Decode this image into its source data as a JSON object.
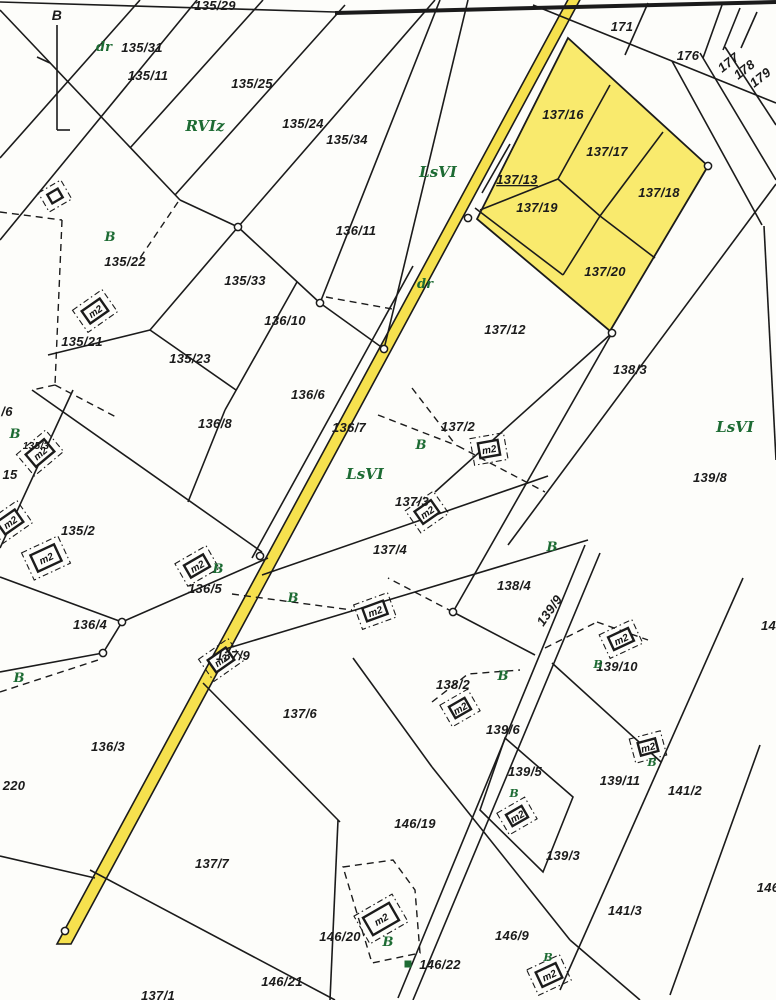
{
  "map": {
    "type": "cadastral-parcel-map",
    "colors": {
      "background": "#fdfdfa",
      "line": "#1b1b1b",
      "road_fill": "#f6e14e",
      "highlight_parcel_fill": "#f9ea6d",
      "green_annotation": "#1d6b33"
    },
    "highlighted_parcels": [
      "137/13",
      "137/16",
      "137/17",
      "137/18",
      "137/19",
      "137/20"
    ],
    "parcel_labels": [
      {
        "text": "135/29",
        "x": 215,
        "y": 10
      },
      {
        "text": "B",
        "x": 57,
        "y": 20,
        "size": 14
      },
      {
        "text": "135/31",
        "x": 142,
        "y": 52
      },
      {
        "text": "135/11",
        "x": 148,
        "y": 80
      },
      {
        "text": "135/25",
        "x": 252,
        "y": 88
      },
      {
        "text": "135/24",
        "x": 303,
        "y": 128
      },
      {
        "text": "135/34",
        "x": 347,
        "y": 144
      },
      {
        "text": "171",
        "x": 622,
        "y": 31
      },
      {
        "text": "176",
        "x": 688,
        "y": 60
      },
      {
        "text": "177",
        "x": 731,
        "y": 66,
        "rot": -38
      },
      {
        "text": "178",
        "x": 747,
        "y": 73,
        "rot": -38
      },
      {
        "text": "179",
        "x": 763,
        "y": 81,
        "rot": -38
      },
      {
        "text": "137/16",
        "x": 563,
        "y": 119
      },
      {
        "text": "137/17",
        "x": 607,
        "y": 156
      },
      {
        "text": "137/13",
        "x": 517,
        "y": 184,
        "underline": true
      },
      {
        "text": "137/18",
        "x": 659,
        "y": 197
      },
      {
        "text": "137/19",
        "x": 537,
        "y": 212
      },
      {
        "text": "137/20",
        "x": 605,
        "y": 276
      },
      {
        "text": "136/11",
        "x": 356,
        "y": 235
      },
      {
        "text": "135/22",
        "x": 125,
        "y": 266
      },
      {
        "text": "135/33",
        "x": 245,
        "y": 285
      },
      {
        "text": "136/10",
        "x": 285,
        "y": 325
      },
      {
        "text": "135/21",
        "x": 82,
        "y": 346
      },
      {
        "text": "135/23",
        "x": 190,
        "y": 363
      },
      {
        "text": "137/12",
        "x": 505,
        "y": 334
      },
      {
        "text": "138/3",
        "x": 630,
        "y": 374
      },
      {
        "text": "136/6",
        "x": 308,
        "y": 399
      },
      {
        "text": "136/8",
        "x": 215,
        "y": 428
      },
      {
        "text": "136/7",
        "x": 349,
        "y": 432
      },
      {
        "text": "137/2",
        "x": 458,
        "y": 431
      },
      {
        "text": "139/8",
        "x": 710,
        "y": 482
      },
      {
        "text": "137/3",
        "x": 412,
        "y": 506
      },
      {
        "text": "135/2",
        "x": 78,
        "y": 535
      },
      {
        "text": "135/3",
        "x": 36,
        "y": 449,
        "size": 10
      },
      {
        "text": "15",
        "x": 10,
        "y": 479
      },
      {
        "text": "/6",
        "x": 7,
        "y": 416
      },
      {
        "text": "137/4",
        "x": 390,
        "y": 554
      },
      {
        "text": "138/4",
        "x": 514,
        "y": 590
      },
      {
        "text": "136/5",
        "x": 205,
        "y": 593
      },
      {
        "text": "139/9",
        "x": 553,
        "y": 613,
        "rot": -55
      },
      {
        "text": "136/4",
        "x": 90,
        "y": 629
      },
      {
        "text": "139/10",
        "x": 617,
        "y": 671
      },
      {
        "text": "138/2",
        "x": 453,
        "y": 689
      },
      {
        "text": "137/6",
        "x": 300,
        "y": 718
      },
      {
        "text": "139/6",
        "x": 503,
        "y": 734
      },
      {
        "text": "136/3",
        "x": 108,
        "y": 751
      },
      {
        "text": "137/9",
        "x": 233,
        "y": 660
      },
      {
        "text": "139/5",
        "x": 525,
        "y": 776
      },
      {
        "text": "139/11",
        "x": 620,
        "y": 785
      },
      {
        "text": "141/2",
        "x": 685,
        "y": 795
      },
      {
        "text": "220",
        "x": 14,
        "y": 790
      },
      {
        "text": "146/19",
        "x": 415,
        "y": 828
      },
      {
        "text": "137/7",
        "x": 212,
        "y": 868
      },
      {
        "text": "139/3",
        "x": 563,
        "y": 860
      },
      {
        "text": "141/3",
        "x": 625,
        "y": 915
      },
      {
        "text": "141/2",
        "x": 778,
        "y": 630
      },
      {
        "text": "146/9",
        "x": 512,
        "y": 940
      },
      {
        "text": "146/20",
        "x": 340,
        "y": 941
      },
      {
        "text": "146/22",
        "x": 440,
        "y": 969
      },
      {
        "text": "146/21",
        "x": 282,
        "y": 986
      },
      {
        "text": "146/",
        "x": 770,
        "y": 892
      },
      {
        "text": "137/1",
        "x": 158,
        "y": 1000
      }
    ],
    "land_use_labels": [
      {
        "text": "RVIz",
        "x": 205,
        "y": 131,
        "size": 15
      },
      {
        "text": "LsVI",
        "x": 438,
        "y": 177,
        "size": 15
      },
      {
        "text": "LsVI",
        "x": 365,
        "y": 479,
        "size": 15
      },
      {
        "text": "LsVI",
        "x": 735,
        "y": 432,
        "size": 15
      },
      {
        "text": "dr",
        "x": 104,
        "y": 51
      },
      {
        "text": "dr",
        "x": 425,
        "y": 288
      },
      {
        "text": "B",
        "x": 110,
        "y": 241
      },
      {
        "text": "B",
        "x": 15,
        "y": 438
      },
      {
        "text": "B",
        "x": 421,
        "y": 449
      },
      {
        "text": "B",
        "x": 218,
        "y": 573
      },
      {
        "text": "B",
        "x": 293,
        "y": 602
      },
      {
        "text": "B",
        "x": 552,
        "y": 551
      },
      {
        "text": "B",
        "x": 19,
        "y": 682
      },
      {
        "text": "B",
        "x": 503,
        "y": 680
      },
      {
        "text": "B",
        "x": 598,
        "y": 668,
        "size": 11
      },
      {
        "text": "B",
        "x": 652,
        "y": 766,
        "size": 11
      },
      {
        "text": "B",
        "x": 514,
        "y": 797,
        "size": 11
      },
      {
        "text": "B",
        "x": 388,
        "y": 946
      },
      {
        "text": "B",
        "x": 548,
        "y": 961,
        "size": 11
      }
    ],
    "building_symbols": [
      {
        "label": "m2",
        "x": 95,
        "y": 311,
        "rot": -35,
        "w": 22,
        "h": 15
      },
      {
        "label": "m2",
        "x": 40,
        "y": 453,
        "rot": -40,
        "w": 24,
        "h": 16
      },
      {
        "label": "m2",
        "x": 10,
        "y": 522,
        "rot": -35,
        "w": 22,
        "h": 15
      },
      {
        "label": "m2",
        "x": 46,
        "y": 558,
        "rot": -25,
        "w": 26,
        "h": 18
      },
      {
        "label": "m2",
        "x": 489,
        "y": 449,
        "rot": -10,
        "w": 20,
        "h": 15
      },
      {
        "label": "m2",
        "x": 427,
        "y": 512,
        "rot": -35,
        "w": 20,
        "h": 15
      },
      {
        "label": "m2",
        "x": 197,
        "y": 566,
        "rot": -30,
        "w": 22,
        "h": 14
      },
      {
        "label": "m2",
        "x": 375,
        "y": 611,
        "rot": -20,
        "w": 22,
        "h": 14
      },
      {
        "label": "m2",
        "x": 221,
        "y": 660,
        "rot": -35,
        "w": 22,
        "h": 15
      },
      {
        "label": "m2",
        "x": 621,
        "y": 639,
        "rot": -25,
        "w": 22,
        "h": 14
      },
      {
        "label": "m2",
        "x": 460,
        "y": 708,
        "rot": -30,
        "w": 18,
        "h": 13
      },
      {
        "label": "m2",
        "x": 648,
        "y": 747,
        "rot": -15,
        "w": 18,
        "h": 13
      },
      {
        "label": "m2",
        "x": 517,
        "y": 816,
        "rot": -30,
        "w": 18,
        "h": 13
      },
      {
        "label": "m2",
        "x": 381,
        "y": 919,
        "rot": -30,
        "w": 30,
        "h": 20
      },
      {
        "label": "m2",
        "x": 549,
        "y": 975,
        "rot": -25,
        "w": 22,
        "h": 16
      },
      {
        "label": "",
        "x": 55,
        "y": 196,
        "rot": -30,
        "w": 12,
        "h": 10
      }
    ],
    "survey_points": [
      [
        708,
        166
      ],
      [
        612,
        333
      ],
      [
        468,
        218
      ],
      [
        384,
        349
      ],
      [
        320,
        303
      ],
      [
        238,
        227
      ],
      [
        260,
        556
      ],
      [
        122,
        622
      ],
      [
        103,
        653
      ],
      [
        453,
        612
      ],
      [
        65,
        931
      ]
    ],
    "green_marker": {
      "x": 408,
      "y": 964,
      "size": 7
    }
  }
}
